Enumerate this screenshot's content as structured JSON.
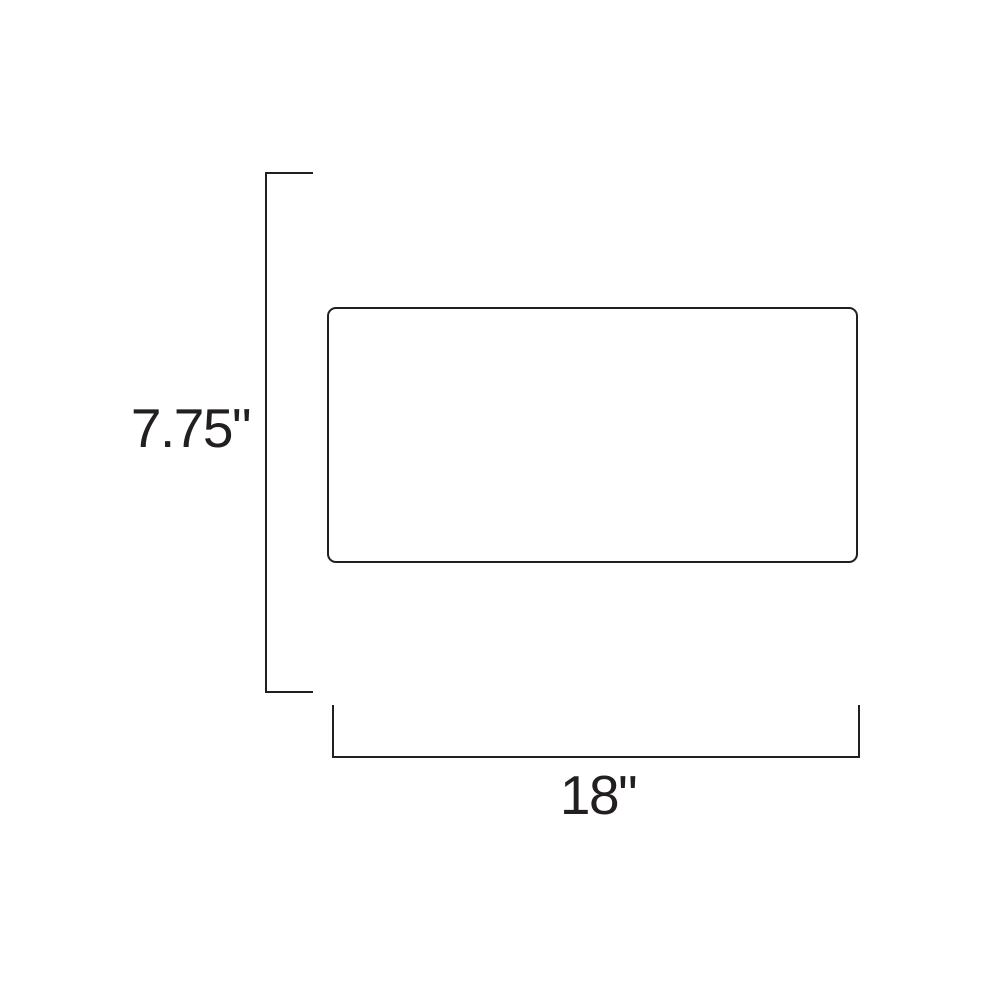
{
  "diagram": {
    "type": "product-dimension-drawing",
    "height_label": "7.75\"",
    "width_label": "18\""
  },
  "colors": {
    "line": "#231f20",
    "background": "#ffffff"
  }
}
